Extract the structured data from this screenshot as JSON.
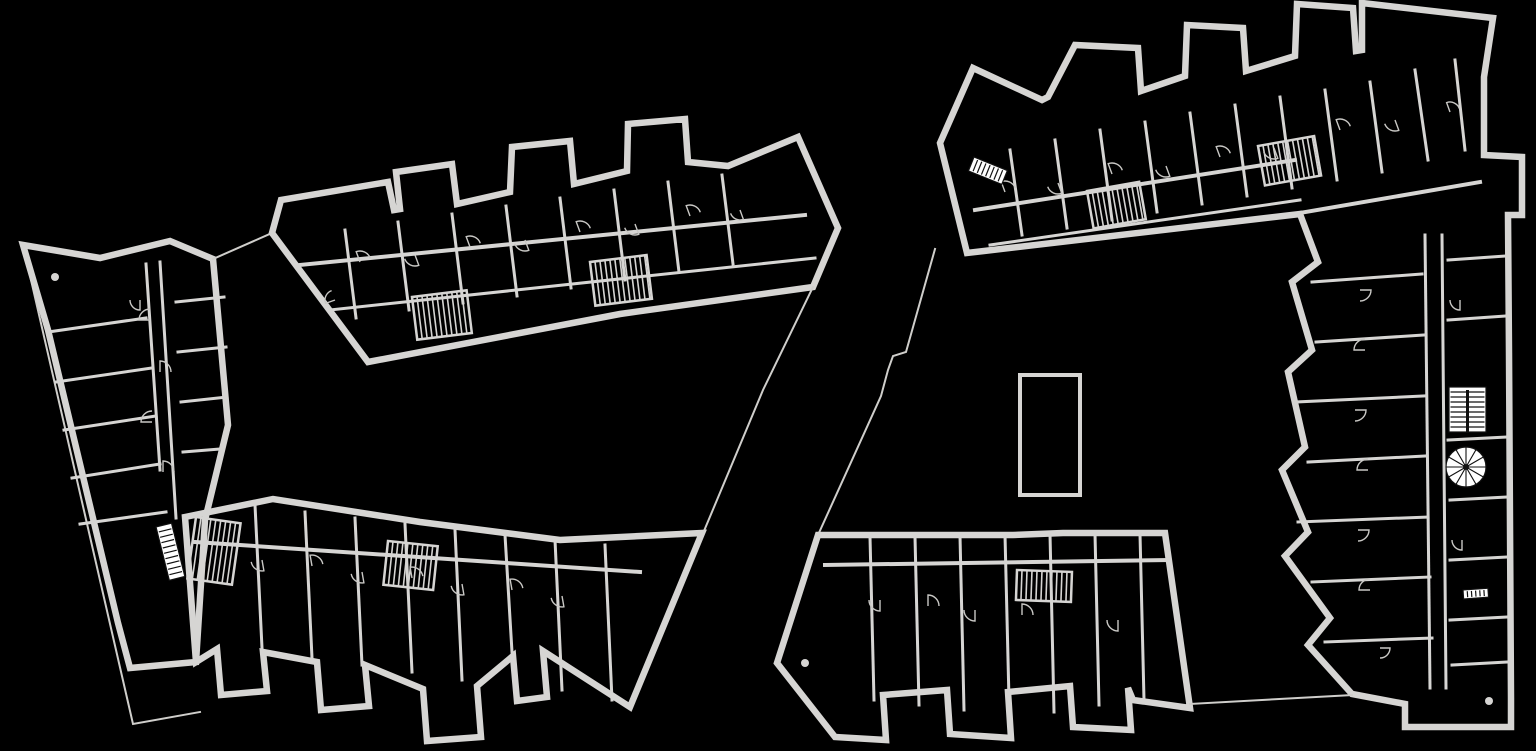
{
  "meta": {
    "kind": "architectural-floor-plan",
    "description": "Two multi-unit residential building floor plans, light linework on black background",
    "buildings": [
      {
        "id": "west-building",
        "label": "west-building"
      },
      {
        "id": "east-building",
        "label": "east-building"
      }
    ]
  },
  "canvas": {
    "width": 1536,
    "height": 751,
    "bg": "#000000",
    "wall": "#d6d5d3",
    "thin": "#cfcecb",
    "arc": "#c9c8c5",
    "hatch": "#d6d5d3",
    "accent": "#ffffff",
    "ink": "#111111"
  },
  "accents": {
    "stair_flights": [
      {
        "name": "west-lower-wing-stair-flight",
        "x": 156,
        "y": 527,
        "w": 16,
        "h": 55,
        "angle": -14,
        "treads": 10,
        "divider": false
      },
      {
        "name": "east-top-wing-stair-flight",
        "x": 974,
        "y": 157,
        "w": 36,
        "h": 15,
        "angle": 22,
        "treads": 8,
        "divider": false
      },
      {
        "name": "east-right-wing-double-stair",
        "x": 1449,
        "y": 387,
        "w": 37,
        "h": 45,
        "angle": 0,
        "treads": 9,
        "divider": true
      },
      {
        "name": "east-right-wing-stair-flight",
        "x": 1463,
        "y": 590,
        "w": 25,
        "h": 9,
        "angle": -4,
        "treads": 6,
        "divider": false
      }
    ],
    "spiral_stair": {
      "name": "east-right-wing-spiral-stair",
      "cx": 1466,
      "cy": 467,
      "r": 20,
      "spokes": 12
    },
    "stair_cores": [
      {
        "name": "west-upper-wing-core-1",
        "x": 412,
        "y": 297,
        "w": 55,
        "h": 43,
        "angle": -7,
        "step": 5
      },
      {
        "name": "west-upper-wing-core-2",
        "x": 590,
        "y": 262,
        "w": 57,
        "h": 44,
        "angle": -7,
        "step": 5
      },
      {
        "name": "west-lower-wing-core-1",
        "x": 196,
        "y": 517,
        "w": 45,
        "h": 62,
        "angle": 8,
        "step": 5
      },
      {
        "name": "west-lower-wing-core-2",
        "x": 388,
        "y": 541,
        "w": 50,
        "h": 44,
        "angle": 6,
        "step": 5
      },
      {
        "name": "east-top-wing-core-1",
        "x": 1087,
        "y": 191,
        "w": 53,
        "h": 38,
        "angle": -10,
        "step": 5
      },
      {
        "name": "east-top-wing-core-2",
        "x": 1258,
        "y": 146,
        "w": 57,
        "h": 40,
        "angle": -10,
        "step": 5
      },
      {
        "name": "east-bottom-wing-core-1",
        "x": 1017,
        "y": 570,
        "w": 55,
        "h": 30,
        "angle": 2,
        "step": 5
      }
    ],
    "columns": [
      {
        "cx": 55,
        "cy": 277,
        "r": 4
      },
      {
        "cx": 805,
        "cy": 663,
        "r": 4
      },
      {
        "cx": 1489,
        "cy": 701,
        "r": 4
      }
    ],
    "door_arcs": [
      {
        "x": 150,
        "y": 320,
        "r": 11,
        "a": 180
      },
      {
        "x": 160,
        "y": 372,
        "r": 11,
        "a": 270
      },
      {
        "x": 152,
        "y": 422,
        "r": 11,
        "a": 180
      },
      {
        "x": 163,
        "y": 472,
        "r": 11,
        "a": 270
      },
      {
        "x": 140,
        "y": 300,
        "r": 10,
        "a": 90
      },
      {
        "x": 360,
        "y": 262,
        "r": 11,
        "a": 250
      },
      {
        "x": 415,
        "y": 255,
        "r": 11,
        "a": 70
      },
      {
        "x": 470,
        "y": 247,
        "r": 11,
        "a": 250
      },
      {
        "x": 525,
        "y": 240,
        "r": 11,
        "a": 70
      },
      {
        "x": 580,
        "y": 232,
        "r": 11,
        "a": 250
      },
      {
        "x": 635,
        "y": 224,
        "r": 11,
        "a": 70
      },
      {
        "x": 690,
        "y": 216,
        "r": 11,
        "a": 250
      },
      {
        "x": 740,
        "y": 210,
        "r": 10,
        "a": 70
      },
      {
        "x": 335,
        "y": 300,
        "r": 10,
        "a": 160
      },
      {
        "x": 262,
        "y": 560,
        "r": 11,
        "a": 80
      },
      {
        "x": 312,
        "y": 566,
        "r": 11,
        "a": 260
      },
      {
        "x": 362,
        "y": 572,
        "r": 11,
        "a": 80
      },
      {
        "x": 412,
        "y": 578,
        "r": 11,
        "a": 260
      },
      {
        "x": 462,
        "y": 584,
        "r": 11,
        "a": 80
      },
      {
        "x": 512,
        "y": 590,
        "r": 11,
        "a": 260
      },
      {
        "x": 562,
        "y": 596,
        "r": 11,
        "a": 80
      },
      {
        "x": 1005,
        "y": 192,
        "r": 11,
        "a": 250
      },
      {
        "x": 1058,
        "y": 183,
        "r": 11,
        "a": 70
      },
      {
        "x": 1112,
        "y": 174,
        "r": 11,
        "a": 250
      },
      {
        "x": 1166,
        "y": 166,
        "r": 11,
        "a": 70
      },
      {
        "x": 1220,
        "y": 157,
        "r": 11,
        "a": 250
      },
      {
        "x": 1274,
        "y": 148,
        "r": 11,
        "a": 70
      },
      {
        "x": 1340,
        "y": 130,
        "r": 11,
        "a": 250
      },
      {
        "x": 1395,
        "y": 120,
        "r": 11,
        "a": 70
      },
      {
        "x": 1450,
        "y": 112,
        "r": 10,
        "a": 250
      },
      {
        "x": 1360,
        "y": 290,
        "r": 11,
        "a": 0
      },
      {
        "x": 1365,
        "y": 350,
        "r": 11,
        "a": 180
      },
      {
        "x": 1355,
        "y": 410,
        "r": 11,
        "a": 0
      },
      {
        "x": 1368,
        "y": 470,
        "r": 11,
        "a": 180
      },
      {
        "x": 1358,
        "y": 530,
        "r": 11,
        "a": 0
      },
      {
        "x": 1370,
        "y": 590,
        "r": 11,
        "a": 180
      },
      {
        "x": 1380,
        "y": 648,
        "r": 10,
        "a": 0
      },
      {
        "x": 1460,
        "y": 300,
        "r": 10,
        "a": 90
      },
      {
        "x": 1462,
        "y": 420,
        "r": 10,
        "a": 270
      },
      {
        "x": 1462,
        "y": 540,
        "r": 10,
        "a": 90
      },
      {
        "x": 880,
        "y": 600,
        "r": 11,
        "a": 90
      },
      {
        "x": 928,
        "y": 606,
        "r": 11,
        "a": 270
      },
      {
        "x": 975,
        "y": 610,
        "r": 11,
        "a": 90
      },
      {
        "x": 1022,
        "y": 615,
        "r": 11,
        "a": 270
      },
      {
        "x": 1118,
        "y": 620,
        "r": 11,
        "a": 90
      }
    ]
  }
}
